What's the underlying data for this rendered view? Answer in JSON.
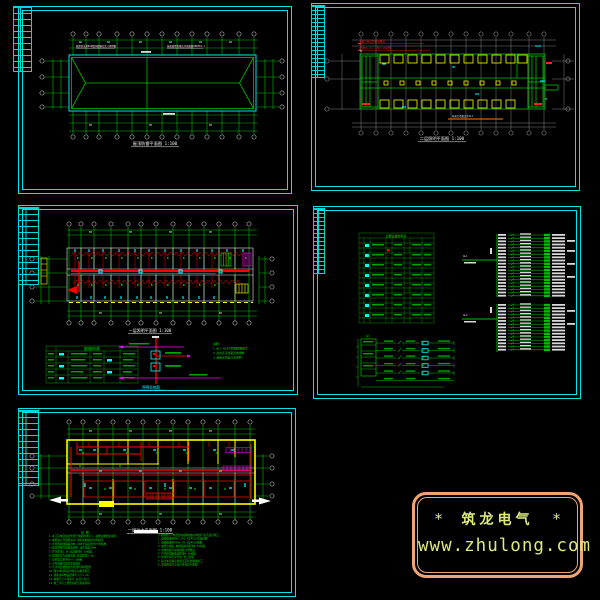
{
  "colors": {
    "background": "#000000",
    "frame_cyan": "#00e5e5",
    "draw_green": "#00c800",
    "red": "#ff0000",
    "yellow": "#ffff00",
    "magenta": "#ff00ff",
    "cyan": "#00ffff",
    "gray_grid": "#8c8c8c",
    "orange_line": "#c06820",
    "logo_border": "#f0a475",
    "logo_text": "#dfe97e"
  },
  "panels": {
    "roof": {
      "title_full": "屋顶防雷平面图 1:100",
      "note_left": "避雷带采用Φ10镀锌圆钢沿女儿墙明敷",
      "note_right": "屋面避雷带做法详见图集99D501-1"
    },
    "floor2": {
      "title_full": "二层照明平面图 1:100",
      "red_note_1": "干线沿吊顶内桥架敷设",
      "red_note_2": "支线BV-2×2.5穿PC16暗敷",
      "orange_note": "桥架沿墙敷设至AL1"
    },
    "lighting": {
      "title_full": "一层照明平面图 1:100",
      "legend_title": "图例材料表",
      "riser_title": "照明系统图",
      "notes": [
        "说明:",
        "1.WL1-WL8为照明回路编号.",
        "2.虚线表示线路沿地暗敷.",
        "3.其余详见设计总说明."
      ]
    },
    "system": {
      "table_title": "主要设备材料表",
      "feeder1": "AL1",
      "feeder2": "AL2",
      "panel_label": "AP"
    },
    "power": {
      "title_full": "一层动力平面图 1:100",
      "notes_heading": "说  明",
      "notes_left": [
        "1.本工程电源由室外低压电缆埋地引入,进线处做重复接地.",
        "2.电缆进户穿钢管保护,钢管两端做好防水处理.",
        "3.室内照明线路采用BV-500型铜芯线穿PC管暗敷.",
        "4.插座回路均设漏电保护,动作电流30mA.",
        "5.开关距地1.3m,插座距地0.3m暗装.",
        "6.配电箱均为嵌墙暗装,底边距地1.5m.",
        "7.接地型式采用TN-C-S系统.",
        "8.卫生间做局部等电位联结.",
        "9.凡穿墙及楼板处的管线均预埋套管.",
        "10.图中未注明者均按有关规范施工.",
        "11.线路水平敷设距地不小于2.5m.",
        "12.本图尺寸以毫米计,标高以米计.",
        "13.施工中与土建密切配合预留预埋."
      ],
      "notes_right": [
        "※弱电部分:电话及电视系统由当地部门负责设计施工.",
        "1.电话线采用RVS-2×0.5穿PC16沿墙暗敷.",
        "2.电视线采用SYKV-75-5穿PC20暗敷.",
        "3.电话出线盒,电视插座均距地0.3m暗装.",
        "4.弱电线路与强电线路分管敷设.",
        "5.户内弱电箱底边距地0.5m暗装.",
        "6.预埋管均应穿带线,管口封堵.",
        "7.其余未尽事宜按规范及标准图集施工.",
        "8.本说明未尽之处详见各层平面图."
      ]
    }
  },
  "logo": {
    "star_left": "*",
    "brand": "筑龙电气",
    "star_right": "*",
    "url": "www.zhulong.com"
  }
}
